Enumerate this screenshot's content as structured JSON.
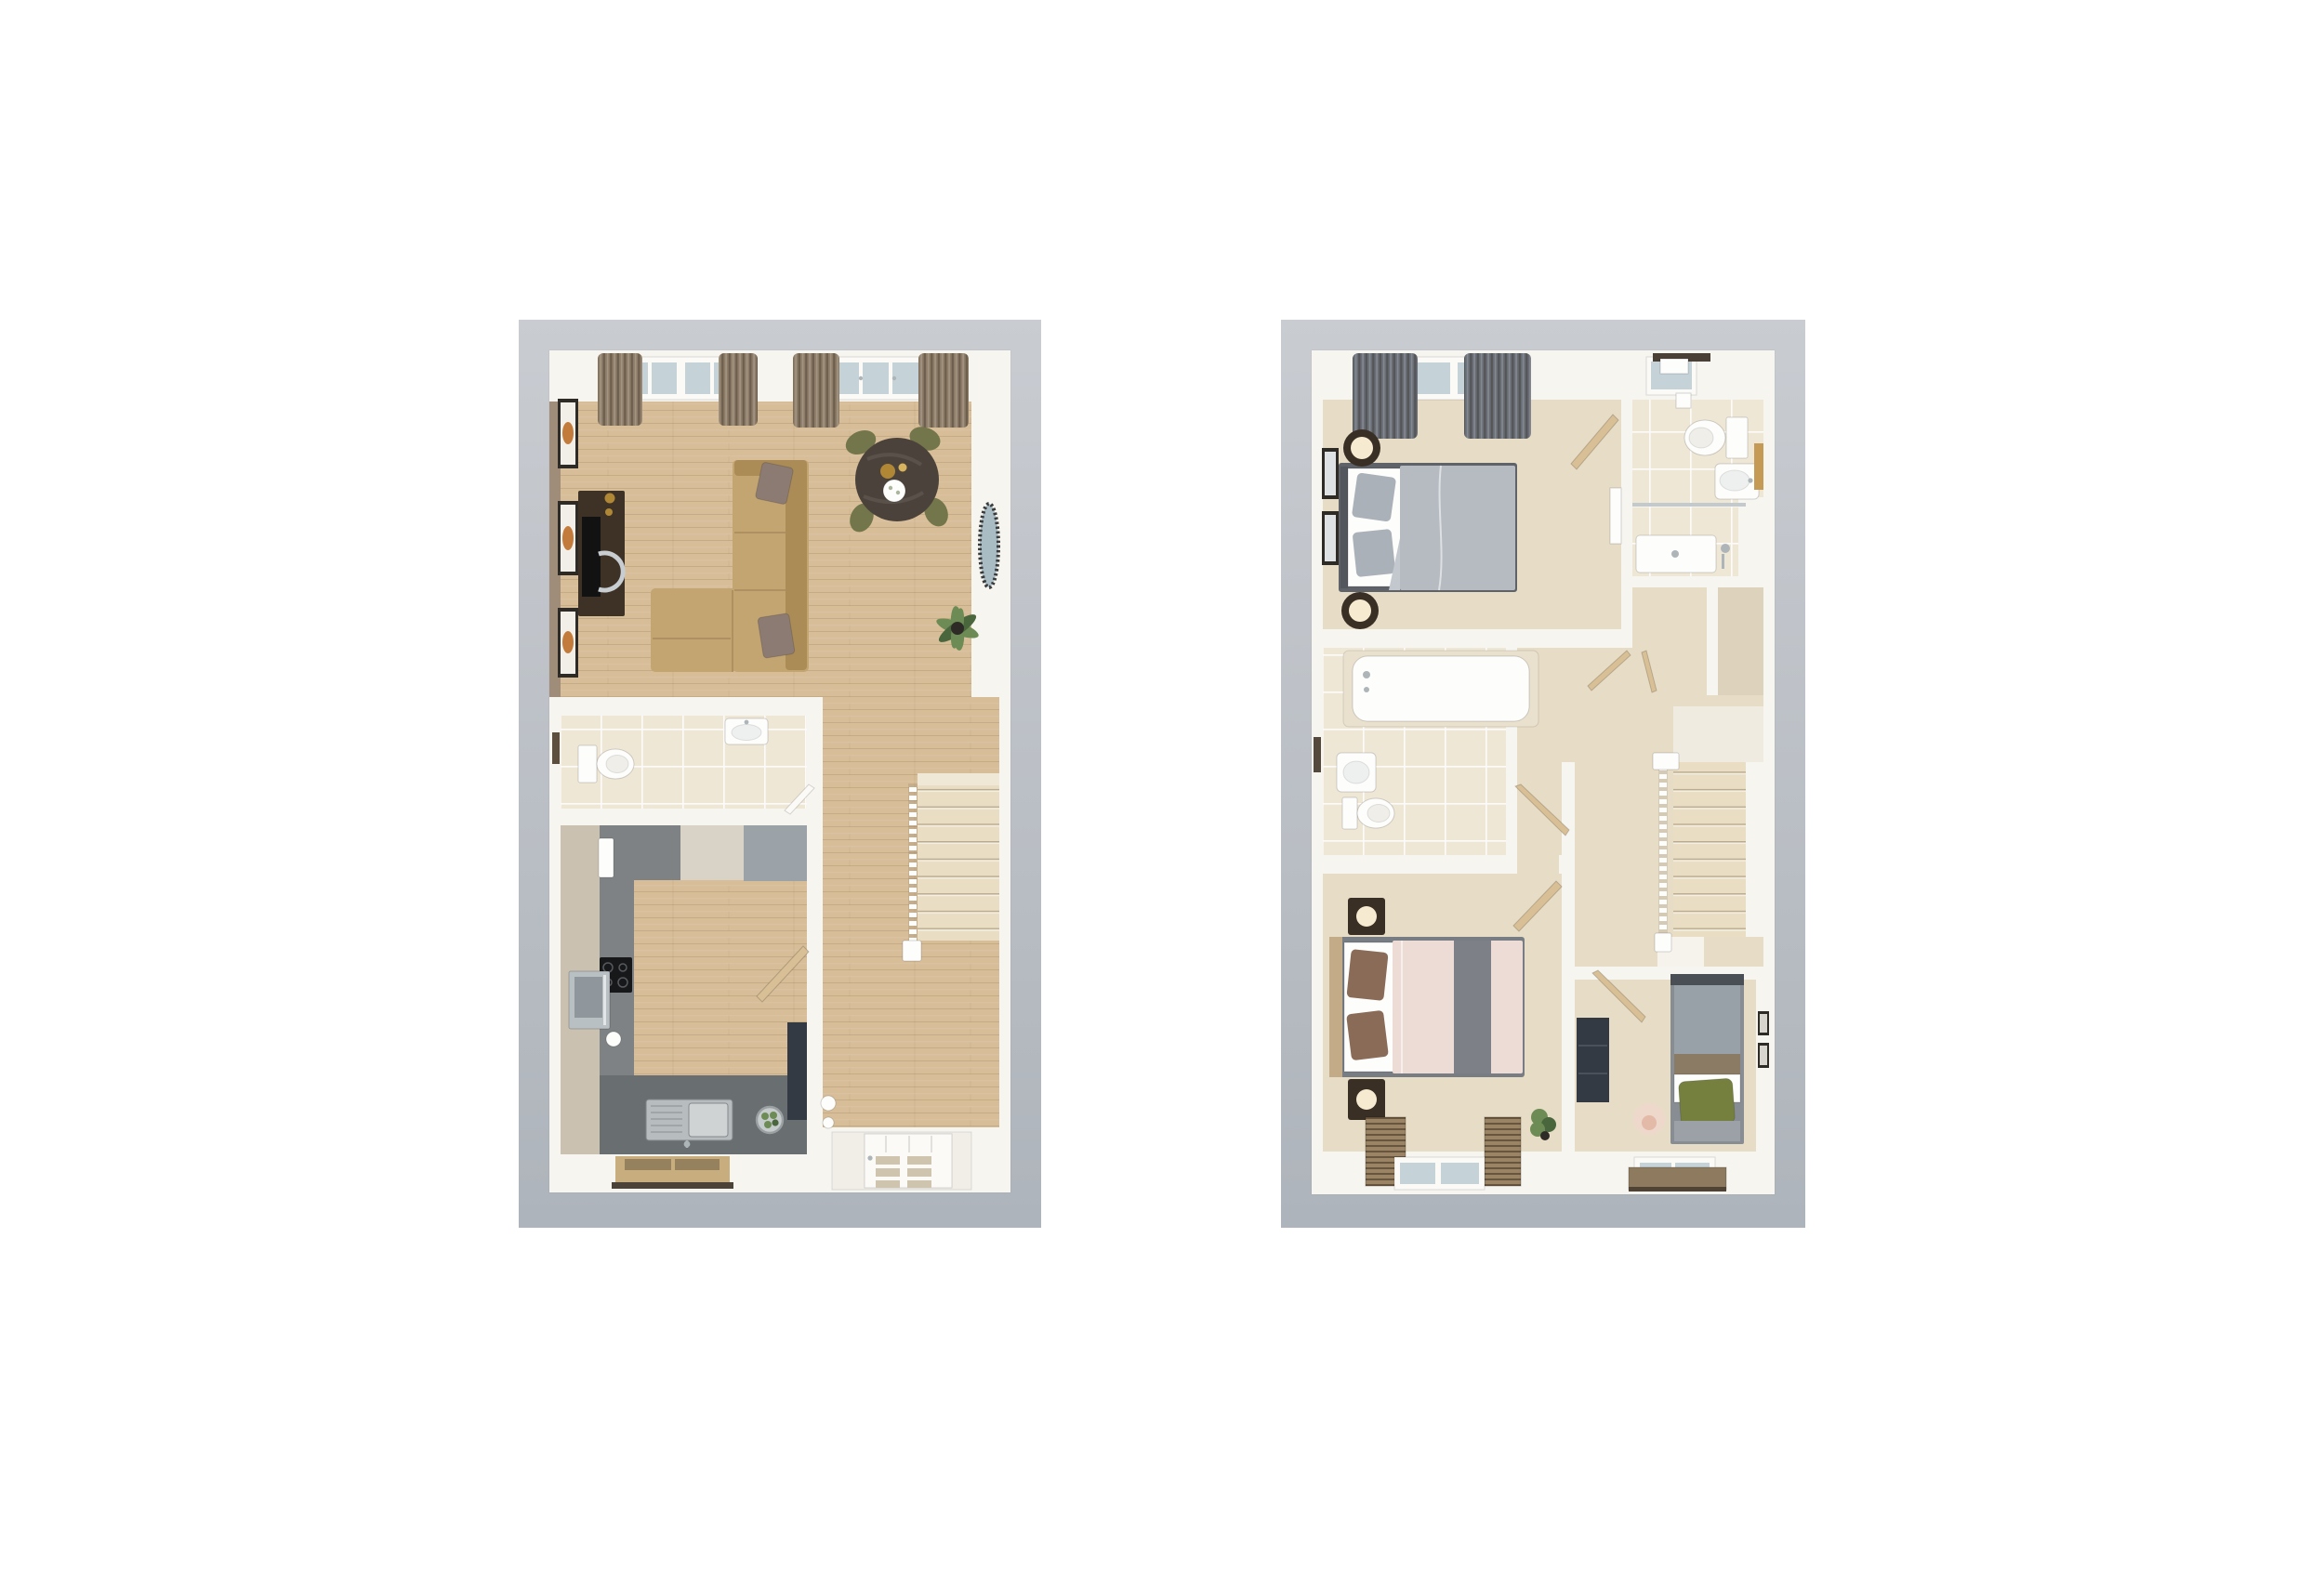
{
  "document": {
    "type": "3d-floorplan-render",
    "panel_count": 2,
    "panels": [
      {
        "name": "ground-floor-plan",
        "rooms": [
          {
            "name": "living-dining-room",
            "floor": "wood",
            "furniture": [
              "corner-sofa",
              "scatter-cushions",
              "tv-unit",
              "tv",
              "wall-art-frames",
              "round-dining-table",
              "dining-chairs",
              "gold-vase",
              "flower-bowl",
              "wall-mirror",
              "curtains",
              "double-window",
              "french-doors",
              "potted-plant"
            ]
          },
          {
            "name": "wc",
            "floor": "tile",
            "furniture": [
              "toilet",
              "basin",
              "towel-radiator"
            ]
          },
          {
            "name": "kitchen",
            "floor": "grey-tile",
            "furniture": [
              "tall-units",
              "wall-units",
              "fridge-unit",
              "radiator",
              "hob",
              "oven",
              "kettle",
              "sink-with-drainer",
              "fruit-bowl",
              "tall-dark-unit",
              "window-board",
              "door"
            ]
          },
          {
            "name": "hallway",
            "floor": "wood",
            "furniture": [
              "staircase",
              "balustrade",
              "newel-post",
              "front-door",
              "vases",
              "door-to-wc"
            ]
          }
        ]
      },
      {
        "name": "first-floor-plan",
        "rooms": [
          {
            "name": "bedroom-1",
            "floor": "carpet",
            "furniture": [
              "double-bed",
              "grey-pillows",
              "bedside-lamps",
              "wall-art-frames",
              "grey-curtains",
              "window",
              "dresser",
              "door"
            ]
          },
          {
            "name": "en-suite",
            "floor": "tile",
            "furniture": [
              "toilet",
              "basin",
              "shower-enclosure",
              "shower-tray",
              "towel-rail",
              "toilet-roll-holder",
              "wood-shelf",
              "window"
            ]
          },
          {
            "name": "bathroom",
            "floor": "tile",
            "furniture": [
              "bath",
              "basin",
              "toilet",
              "towel-rail",
              "door"
            ]
          },
          {
            "name": "landing",
            "floor": "carpet",
            "furniture": [
              "staircase",
              "balustrade",
              "newel-posts",
              "airing-cupboard",
              "doors"
            ]
          },
          {
            "name": "bedroom-2",
            "floor": "carpet",
            "furniture": [
              "double-bed",
              "brown-pillows",
              "bedside-lamps",
              "slatted-radiators",
              "window",
              "potted-plant",
              "door"
            ]
          },
          {
            "name": "bedroom-3",
            "floor": "carpet",
            "furniture": [
              "single-bed",
              "green-cushion",
              "drawer-unit",
              "pink-lamp",
              "wall-art-frames",
              "desk-shelf",
              "window",
              "door"
            ]
          }
        ]
      }
    ]
  },
  "colors": {
    "page_bg": "#ffffff",
    "card_top": "#c9ccd1",
    "card_bottom": "#aeb4bb",
    "wall": "#f7f5f0",
    "wall_face": "#f0ebe1",
    "accent_wall": "#a08d79",
    "wood": "#d7bd98",
    "carpet": "#e7dcc5",
    "tile": "#efe7d6",
    "stairs_carpet": "#e9ddc3",
    "kitchen_floor": "#7e8284",
    "worktop": "#696e70",
    "cabinet_beige": "#cbc1b0",
    "cabinet_cream": "#d9d2c6",
    "cabinet_grey": "#9ba3a9",
    "sofa": "#c3a572",
    "sofa_dark": "#ab8c57",
    "cushion_taupe": "#8c7b72",
    "dining_table": "#4b433b",
    "chair_olive": "#72764a",
    "tv_unit": "#3e3226",
    "curtain_brown": "#8d7c67",
    "curtain_grey": "#696e76",
    "bed1_frame": "#5f6369",
    "bed1_duvet": "#b5bbc1",
    "bed1_pillow": "#aab1b8",
    "bed2_frame": "#787d84",
    "bed2_duvet": "#ecdcd5",
    "bed2_pillow": "#8a6b57",
    "bed2_runner": "#7d8187",
    "bed2_head": "#c4ab87",
    "bed3_duvet": "#99a1a8",
    "bed3_green": "#75803f",
    "bed3_brown": "#8c7b64",
    "door_leaf": "#d8bf95",
    "glass": "#c5d2d8",
    "frame_white": "#fbfaf7",
    "steel": "#aeb5b9",
    "gold": "#b08735",
    "black_frame": "#2e2b27",
    "navy": "#333a44",
    "plant": "#6d8c55",
    "plant_dark": "#49663c",
    "white_fixture": "#fdfdfc",
    "lamp_warm": "#f6ead0",
    "lamp_bronze": "#3a2f25",
    "lamp_pink": "#eed7cb",
    "wood_board": "#c8ad7f"
  }
}
